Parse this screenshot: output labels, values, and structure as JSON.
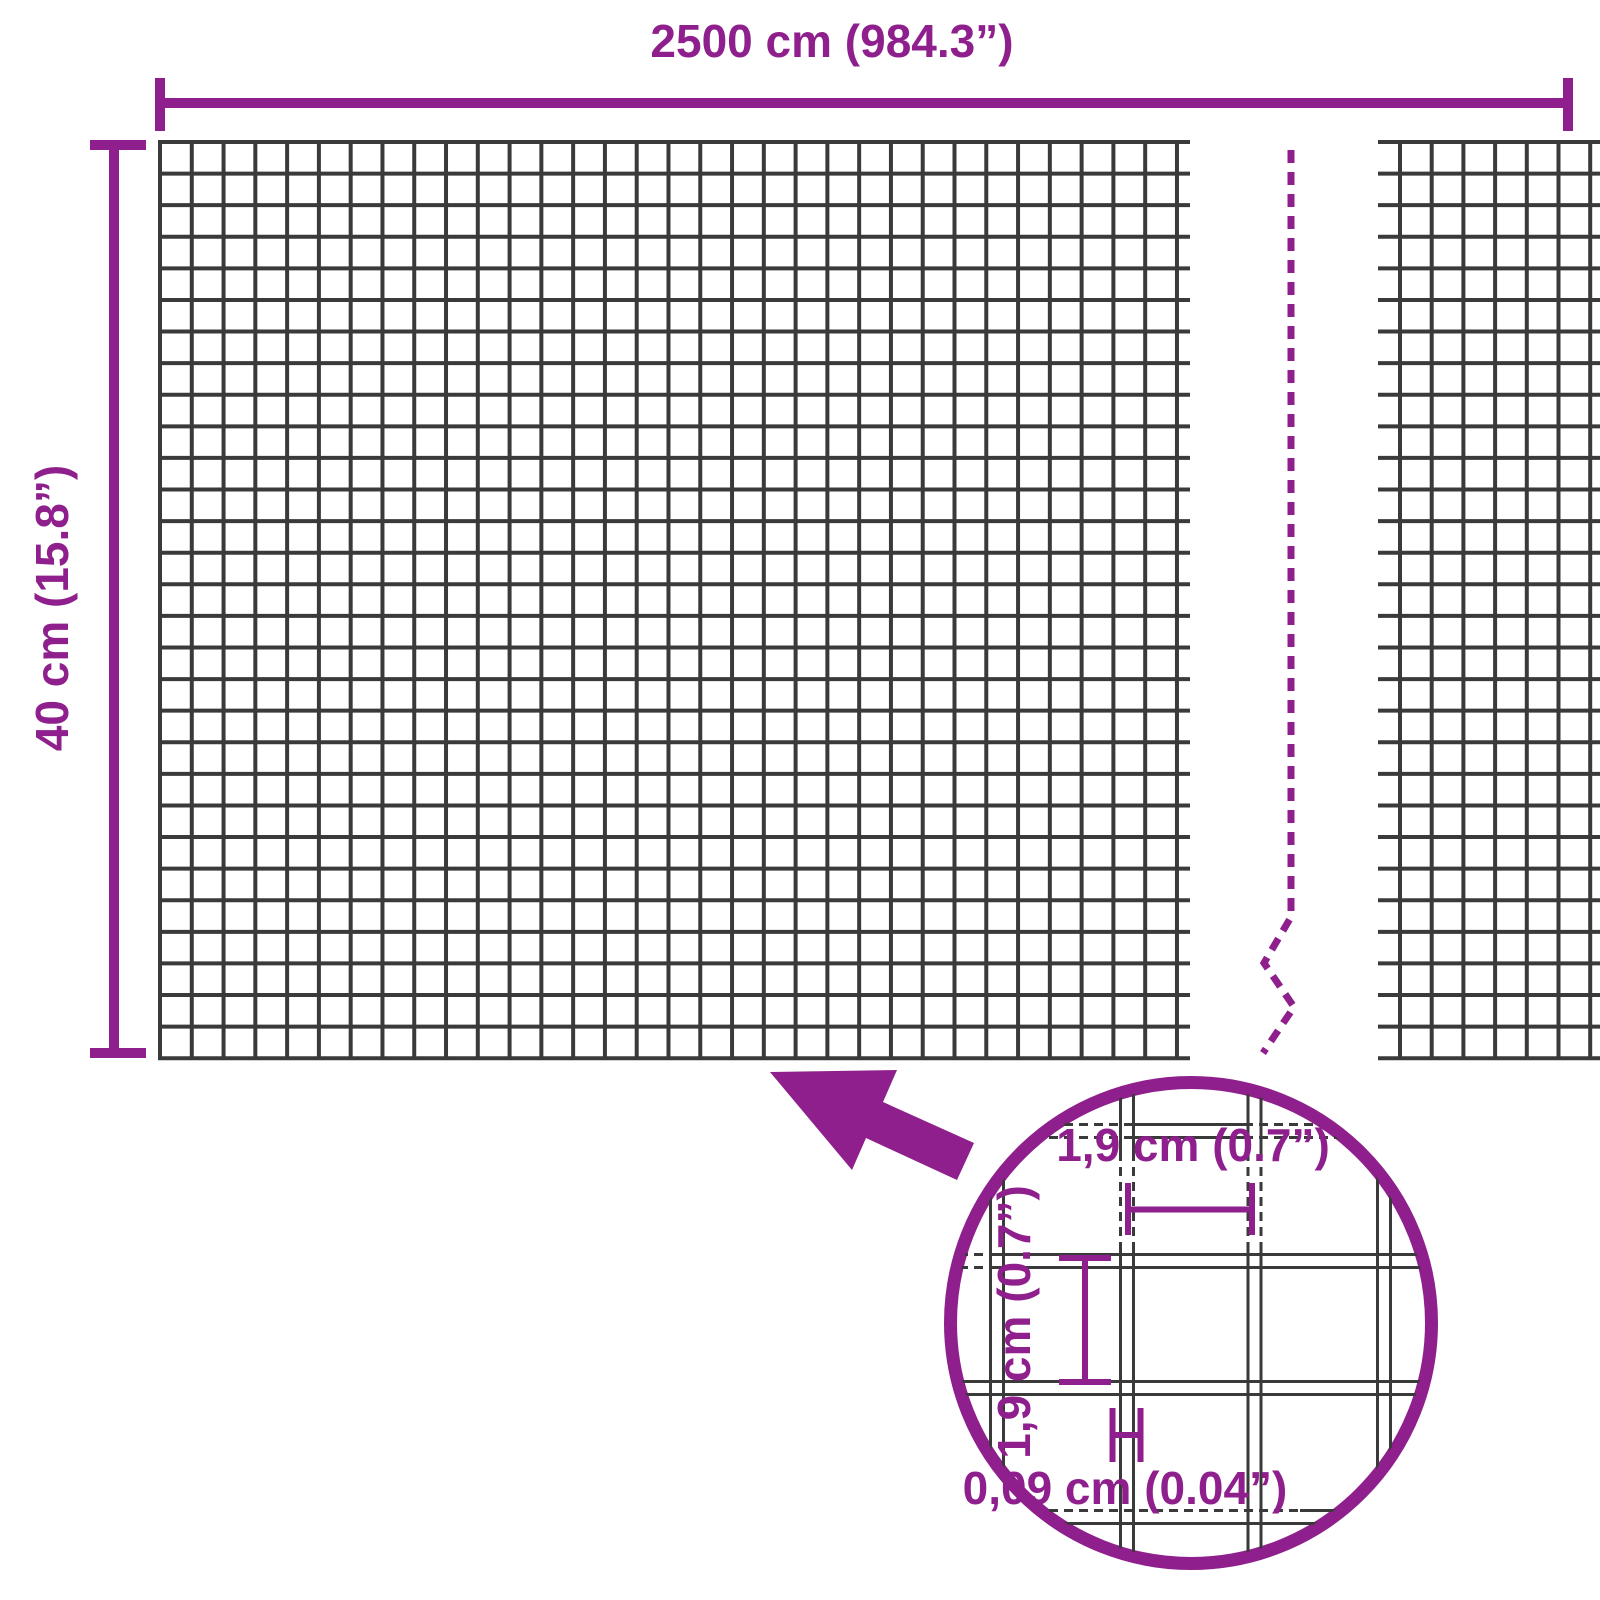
{
  "diagram": {
    "type": "wire-mesh-dimension-diagram",
    "total_width_label": "2500 cm (984.3”)",
    "total_height_label": "40 cm (15.8”)",
    "detail": {
      "cell_width_label": "1,9 cm (0.7”)",
      "cell_height_label": "1,9 cm (0.7”)",
      "wire_thickness_label": "0,09 cm (0.04”)"
    },
    "icons": {
      "zoom_arrow": "arrow-pointing-up-left-from-detail-circle",
      "magnifier_circle": "circular-zoom-detail-view",
      "break_line": "dashed-zigzag-continuation-line"
    }
  },
  "colors": {
    "accent": "#8E1F8C",
    "wire": "#3A3A3A",
    "background": "#FFFFFF"
  }
}
